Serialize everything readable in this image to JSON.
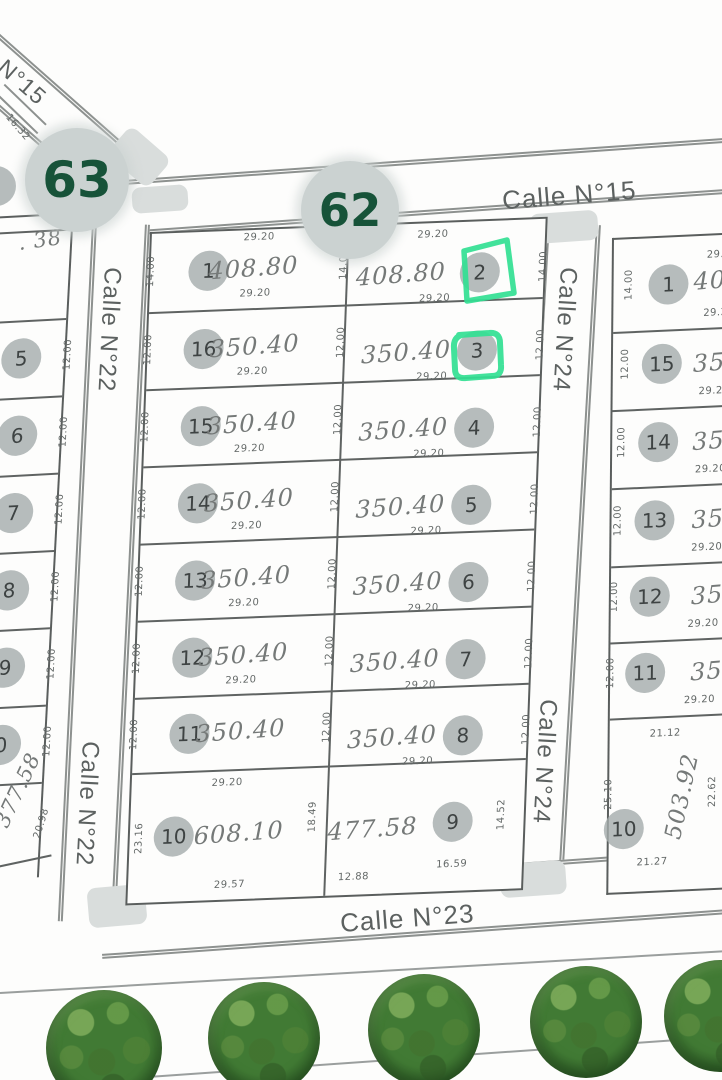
{
  "streets": {
    "c15": "Calle N°15",
    "c15_diag": "N°15",
    "c22a": "Calle N°22",
    "c22b": "Calle N°22",
    "c23": "Calle N°23",
    "c24a": "Calle N°24",
    "c24b": "Calle N°24"
  },
  "badges": {
    "b63": "63",
    "b62": "62"
  },
  "highlight_color": "#32e093",
  "center": {
    "rows": [
      {
        "l": {
          "n": "1",
          "a": "408.80",
          "t": "29.20",
          "b": "29.20",
          "wl": "14.00",
          "wr": "14.00"
        },
        "r": {
          "n": "2",
          "a": "408.80",
          "t": "29.20",
          "b": "29.20",
          "wr": "14.00"
        }
      },
      {
        "l": {
          "n": "16",
          "a": "350.40",
          "b": "29.20",
          "wl": "12.00",
          "wr": "12.00"
        },
        "r": {
          "n": "3",
          "a": "350.40",
          "b": "29.20",
          "wr": "12.00"
        }
      },
      {
        "l": {
          "n": "15",
          "a": "350.40",
          "b": "29.20",
          "wl": "12.00",
          "wr": "12.00"
        },
        "r": {
          "n": "4",
          "a": "350.40",
          "b": "29.20",
          "wr": "12.00"
        }
      },
      {
        "l": {
          "n": "14",
          "a": "350.40",
          "b": "29.20",
          "wl": "12.00",
          "wr": "12.00"
        },
        "r": {
          "n": "5",
          "a": "350.40",
          "b": "29.20",
          "wr": "12.00"
        }
      },
      {
        "l": {
          "n": "13",
          "a": "350.40",
          "b": "29.20",
          "wl": "12.00",
          "wr": "12.00"
        },
        "r": {
          "n": "6",
          "a": "350.40",
          "b": "29.20",
          "wr": "12.00"
        }
      },
      {
        "l": {
          "n": "12",
          "a": "350.40",
          "b": "29.20",
          "wl": "12.00",
          "wr": "12.00"
        },
        "r": {
          "n": "7",
          "a": "350.40",
          "b": "29.20",
          "wr": "12.00"
        }
      },
      {
        "l": {
          "n": "11",
          "a": "350.40",
          "wl": "12.00",
          "wr": "12.00"
        },
        "r": {
          "n": "8",
          "a": "350.40",
          "b": "29.20",
          "wr": "12.00"
        }
      },
      {
        "l": {
          "n": "10",
          "a": "608.10",
          "t": "29.20",
          "b": "29.57",
          "wl": "23.16",
          "wr": "18.49"
        },
        "r": {
          "n": "9",
          "a": "477.58",
          "bl": "12.88",
          "br": "16.59",
          "wr": "14.52"
        }
      }
    ]
  },
  "left_strip": {
    "area_top": ". 38",
    "dim_top": "16.32",
    "lots": [
      {
        "n": "5",
        "w": "12.00"
      },
      {
        "n": "6",
        "w": "12.00"
      },
      {
        "n": "7",
        "w": "12.00"
      },
      {
        "n": "8",
        "w": "12.00"
      },
      {
        "n": "9",
        "w": "12.00"
      },
      {
        "n": "0",
        "w": "12.00"
      }
    ],
    "area_bottom": "377.58",
    "dim_bottom": "20.98"
  },
  "right_strip": {
    "rows": [
      {
        "n": "1",
        "a": "408.80",
        "t": "29.20",
        "b": "29.20",
        "wl": "14.00"
      },
      {
        "n": "15",
        "a": "350.40",
        "b": "29.20",
        "wl": "12.00"
      },
      {
        "n": "14",
        "a": "350.40",
        "b": "29.20",
        "wl": "12.00"
      },
      {
        "n": "13",
        "a": "350.40",
        "b": "29.20",
        "wl": "12.00"
      },
      {
        "n": "12",
        "a": "350.40",
        "b": "29.20",
        "wl": "12.00"
      },
      {
        "n": "11",
        "a": "350.40",
        "b": "29.20",
        "wl": "12.00"
      }
    ],
    "lot10": {
      "n": "10",
      "a": "503.92",
      "t": "21.12",
      "b": "21.27",
      "wl": "25.10",
      "wr": "22.62"
    }
  }
}
